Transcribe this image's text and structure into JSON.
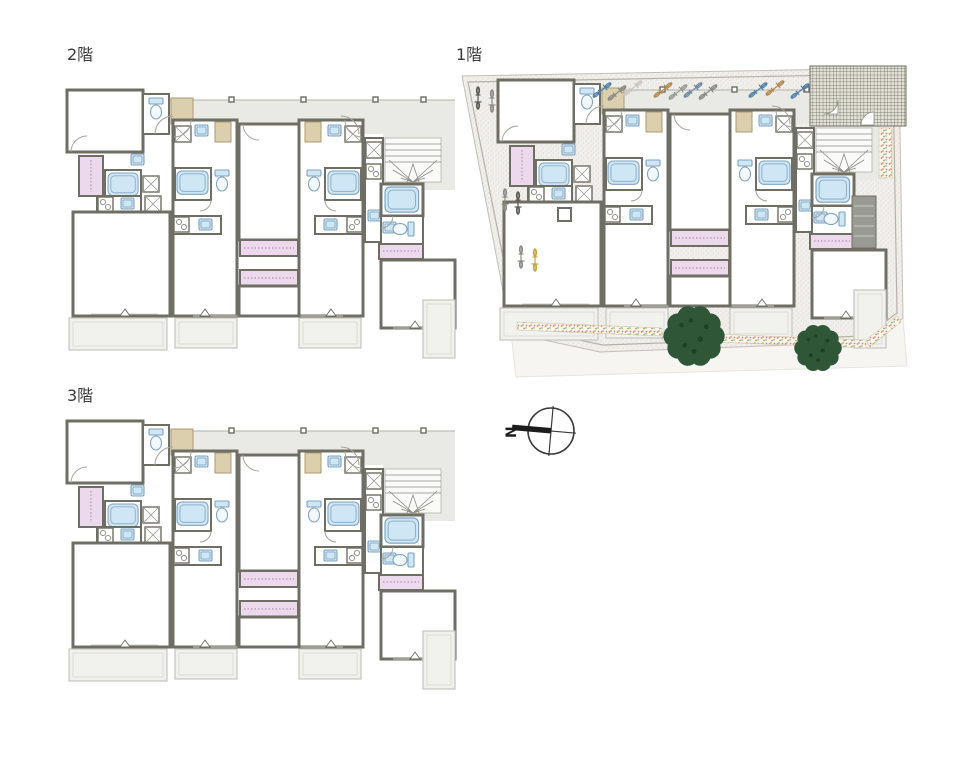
{
  "sheet": {
    "background": "#ffffff"
  },
  "plans": {
    "floor2": {
      "label": "2階"
    },
    "floor1": {
      "label": "1階"
    },
    "floor3": {
      "label": "3階"
    }
  },
  "compass": {
    "label": "N"
  },
  "palette": {
    "wall": "#6e6e64",
    "corridor": "#e9e9e6",
    "fixture_blue": "#cfe6f5",
    "closet_pink": "#ecdaec",
    "shelf_beige": "#dccfae",
    "balcony": "#f1f1ee",
    "site_ground": "#f1efeb",
    "tree_green": "#2e5637"
  }
}
